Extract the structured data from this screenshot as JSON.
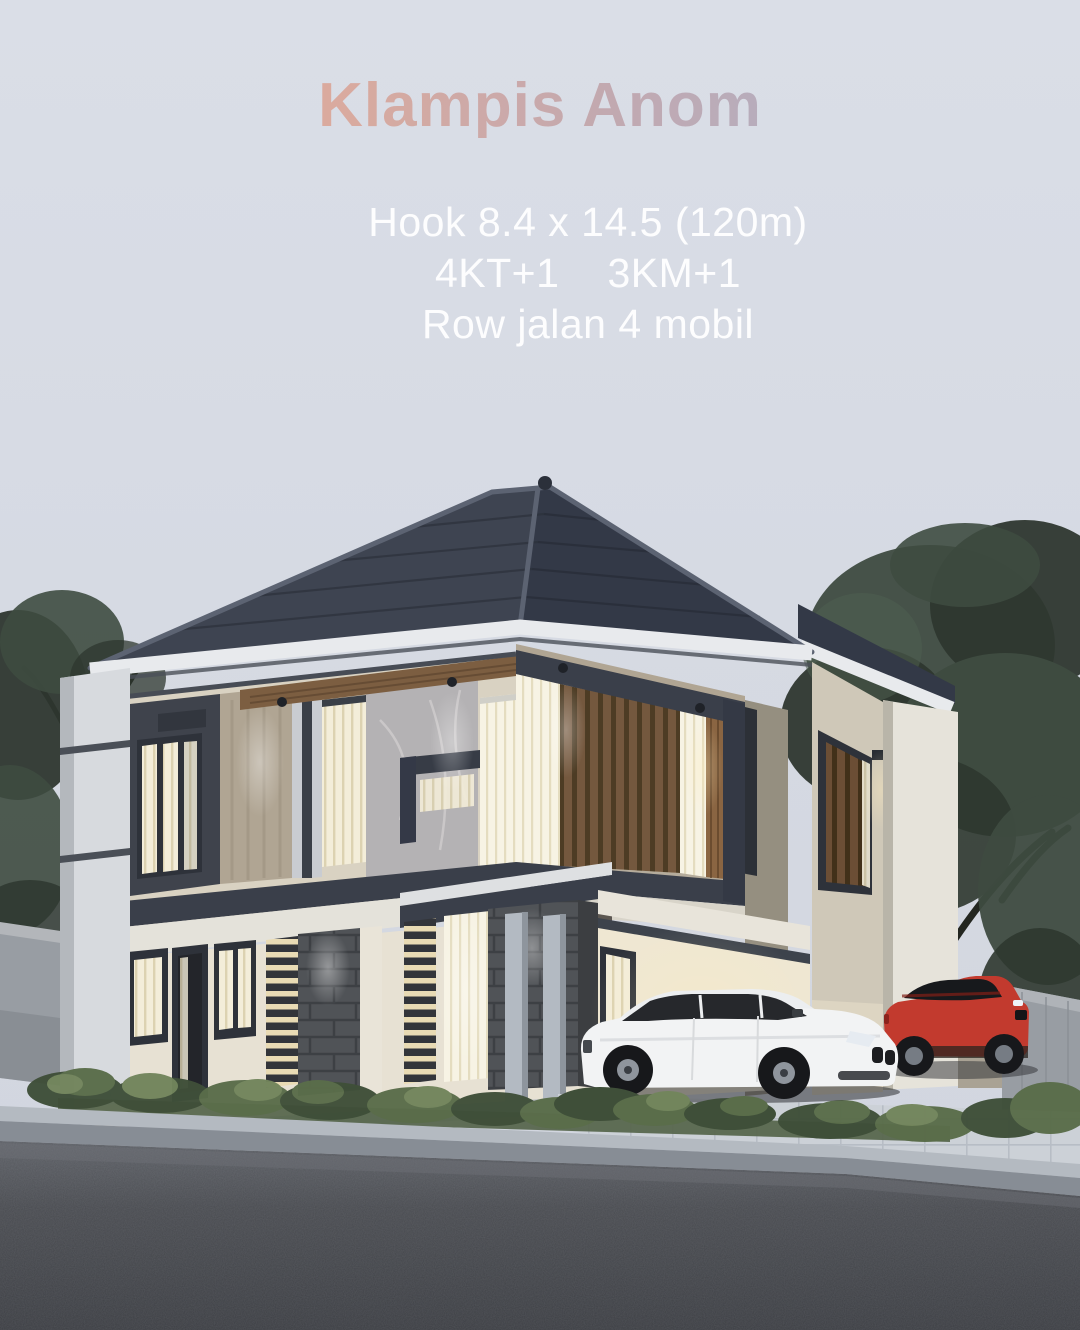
{
  "poster": {
    "title": {
      "text": "Klampis Anom"
    },
    "specs": {
      "size": "Hook 8.4 x 14.5 (120m)",
      "bedrooms": "4KT+1",
      "bathrooms": "3KM+1",
      "road_access": "Row jalan 4 mobil"
    }
  },
  "scene": {
    "colors": {
      "sky": "#d8dce5",
      "title_start": "#e7a68f",
      "title_mid": "#bfa5ad",
      "title_end": "#a8aec9",
      "spec_text": "#ffffff",
      "roof": "#3e4451",
      "roof_side": "#333947",
      "fascia": "#e8eaed",
      "trim_dark": "#3a3f4a",
      "wall_upper": "#d9d2c2",
      "travertine": "#b0a593",
      "marble": "#b4b2b4",
      "panel_dark": "#3f434c",
      "wood_soffit": "#7c5e41",
      "wood_slat": "#6b4e35",
      "window_lit": "#f3edd9",
      "window_frame": "#2e323a",
      "slab": "#e4e2da",
      "wall_ground": "#e7e1d3",
      "porch_lit": "#efe7d2",
      "stone": "#505357",
      "column": "#b3bac2",
      "pilaster": "#d7dade",
      "neighbor_pilaster": "#e6e3da",
      "boundary_wall": "#989da3",
      "foliage_dark": "#2e372f",
      "foliage_mid": "#3e4b40",
      "foliage_light": "#4f5f50",
      "shrub_dark": "#3f4f39",
      "shrub_mid": "#5a6d4a",
      "shrub_light": "#72855c",
      "grass": "#55644a",
      "driveway": "#ccd1d7",
      "curb_top": "#b4bac1",
      "curb_face": "#878d95",
      "road": "#45474c",
      "car_white": "#f2f3f4",
      "car_red": "#c23a2e",
      "glass_dark": "#26282c",
      "wheel": "#17181b"
    }
  }
}
